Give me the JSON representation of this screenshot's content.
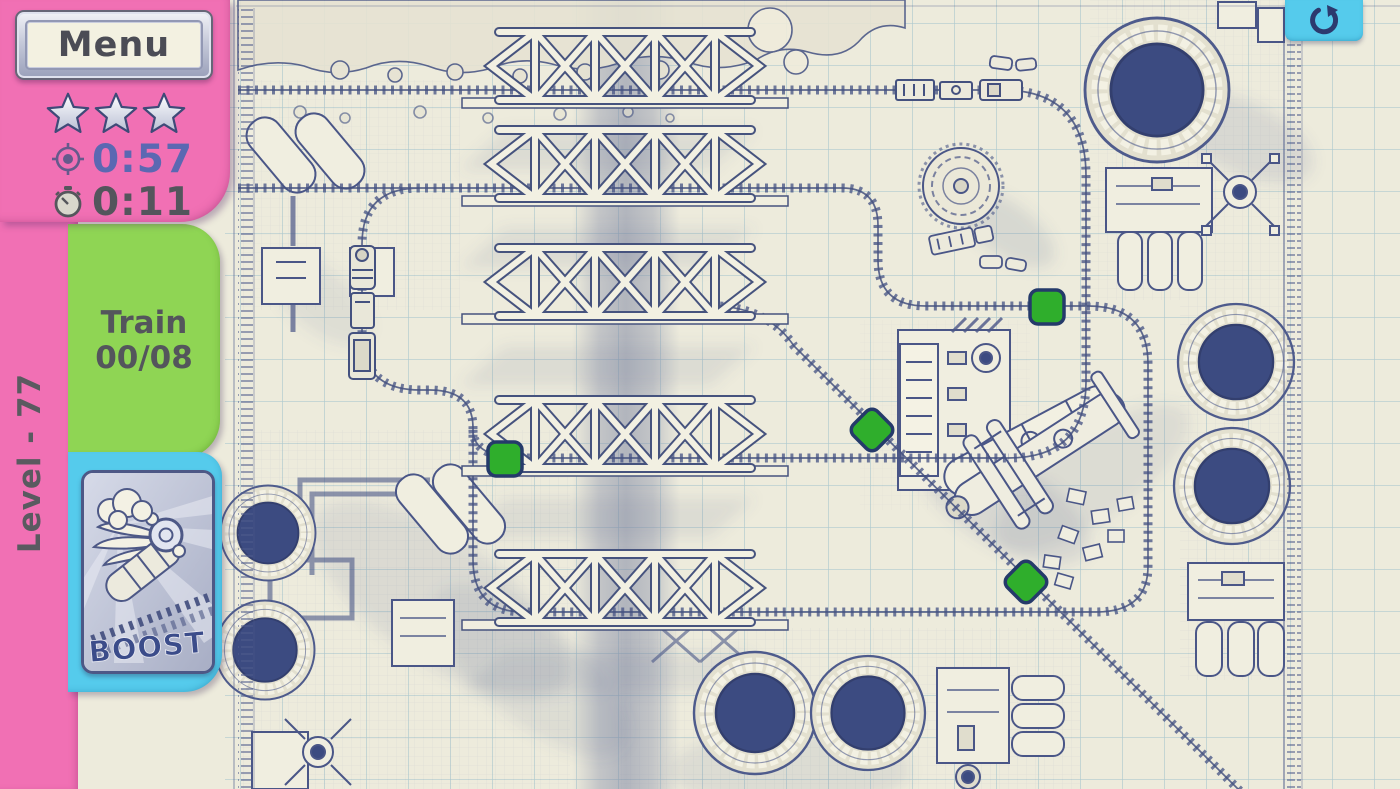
{
  "hud": {
    "menu_label": "Menu",
    "stars_earned": 3,
    "best_time": "0:57",
    "elapsed_time": "0:11",
    "train_word": "Train",
    "train_count": "00/08",
    "level_label": "Level - 77",
    "boost_label": "BOOST"
  },
  "colors": {
    "sidebar_pink": "#f170b4",
    "tab_green": "#8fd554",
    "tab_cyan": "#55cbec",
    "paper": "#edebdc",
    "grid_blue": "#a4c3cb",
    "blueprint_ink": "#4a5687",
    "tower_fill": "#3c4b81",
    "switch_green": "#2fae2c",
    "best_time_blue": "#5b68b2",
    "elapsed_gray": "#54555c"
  },
  "playfield": {
    "grid_cell_px": 42,
    "switches": [
      {
        "id": 1,
        "shape": "square",
        "x": 505,
        "y": 459
      },
      {
        "id": 2,
        "shape": "square",
        "x": 1047,
        "y": 307
      },
      {
        "id": 3,
        "shape": "diamond",
        "x": 872,
        "y": 430
      },
      {
        "id": 4,
        "shape": "diamond",
        "x": 1026,
        "y": 582
      }
    ]
  }
}
